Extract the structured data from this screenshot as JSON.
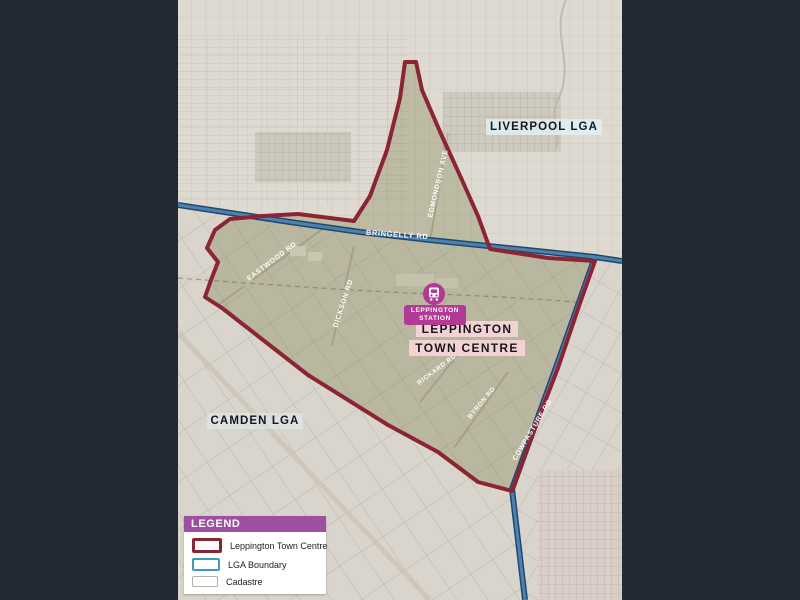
{
  "canvas": {
    "background": "#232933"
  },
  "map": {
    "region_labels": {
      "liverpool": "LIVERPOOL LGA",
      "camden": "CAMDEN LGA"
    },
    "town_centre_label": {
      "line1": "LEPPINGTON",
      "line2": "TOWN CENTRE"
    },
    "station": {
      "line1": "LEPPINGTON",
      "line2": "STATION"
    },
    "roads": {
      "bringelly": "BRINGELLY RD",
      "eastwood": "EASTWOOD RD",
      "dickson": "DICKSON RD",
      "edmondson": "EDMONDSON AVE",
      "rickard": "RICKARD RD",
      "byron": "BYRON RD",
      "cowpasture": "COWPASTURE RD"
    },
    "colors": {
      "town_centre_boundary": "#8b2433",
      "lga_boundary_line": "#4a83b0",
      "station_marker": "#b23a94",
      "town_centre_label_bg": "#f3d2d4",
      "surround": "#232933"
    }
  },
  "legend": {
    "title": "LEGEND",
    "header_color": "#9d50a0",
    "items": [
      {
        "label": "Leppington Town Centre",
        "swatch_color": "#8b2433"
      },
      {
        "label": "LGA Boundary",
        "swatch_color": "#3d9cba"
      },
      {
        "label": "Cadastre",
        "swatch_color": "#b5b1a8"
      }
    ]
  }
}
